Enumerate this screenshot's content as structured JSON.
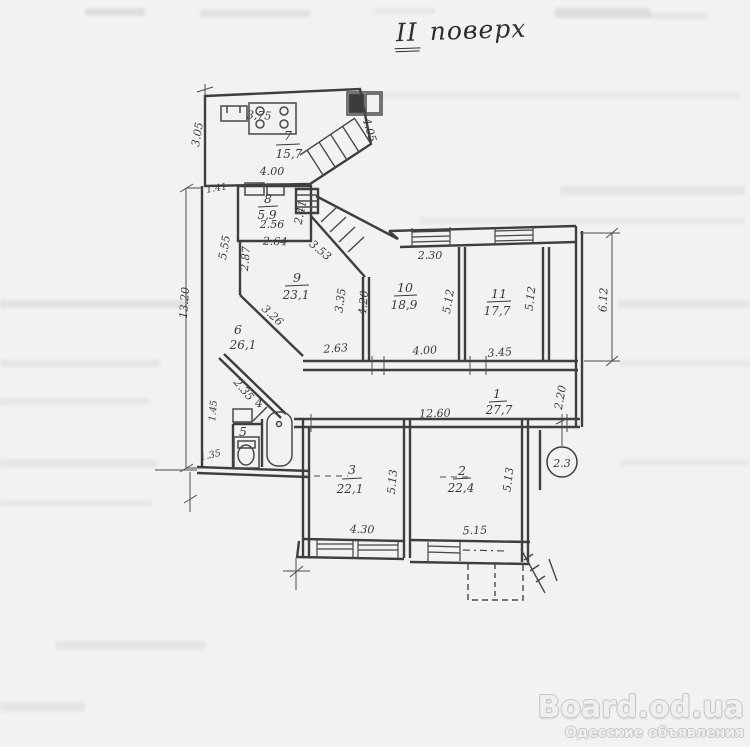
{
  "title": {
    "roman": "II",
    "word": "поверх",
    "full": "II поверх"
  },
  "floor_plan": {
    "rooms": {
      "r1": {
        "number": "1",
        "area": "27,7"
      },
      "r2": {
        "number": "2",
        "area": "22,4"
      },
      "r3": {
        "number": "3",
        "area": "22,1"
      },
      "r4": {
        "number": "4"
      },
      "r5": {
        "number": "5"
      },
      "r6": {
        "number": "6",
        "area": "26,1"
      },
      "r7": {
        "number": "7",
        "area": "15,7"
      },
      "r8": {
        "number": "8",
        "area": "5,9"
      },
      "r9": {
        "number": "9",
        "area": "23,1"
      },
      "r10": {
        "number": "10",
        "area": "18,9"
      },
      "r11": {
        "number": "11",
        "area": "17,7"
      }
    },
    "dims": {
      "left_height": "13.20",
      "room7_left": "3.05",
      "room7_top": "3,75",
      "room7_bottom": "4.00",
      "room7_right": "4.05",
      "small_left": "1.41",
      "room8_width": "2.56",
      "room8_width2": "2.64",
      "room8_right": "2.41",
      "room9_left1": "5.55",
      "room9_left2": "2.87",
      "stairs_diag": "3.53",
      "room9_diag": "3.26",
      "bath_diag": "2.35",
      "bath_left": "1.45",
      "wc_width": "1.35",
      "corr_seg1": "2.63",
      "corr_seg2": "4.00",
      "corr_seg3": "3.45",
      "room10_window": "2.30",
      "room10_left1": "3.35",
      "room10_left2": "4.20",
      "room10_right": "5.12",
      "room11_right": "5.12",
      "right_height": "6.12",
      "corr_width": "2.20",
      "corr_length": "12.60",
      "room3_height": "5.13",
      "room2_height": "5.13",
      "room3_bottom": "4.30",
      "room2_bottom": "5.15"
    },
    "circled_note": "2.3"
  },
  "watermark": {
    "brand": "Board.od.ua",
    "subtitle": "Одесские объявления"
  }
}
